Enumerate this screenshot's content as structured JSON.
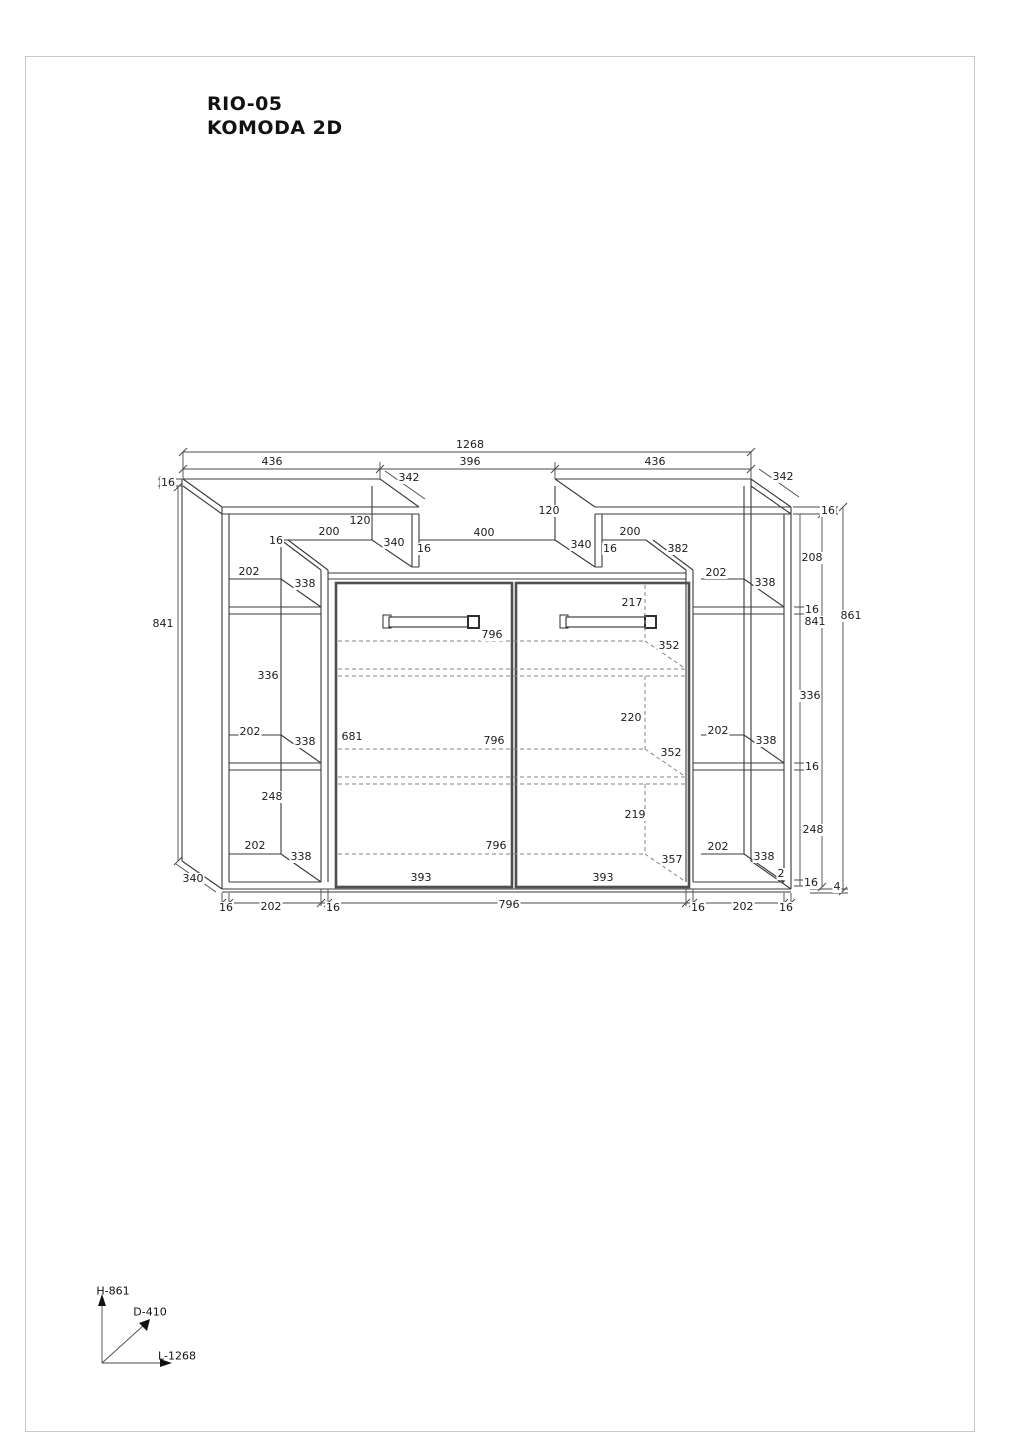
{
  "title": {
    "line1": "RIO-05",
    "line2": "KOMODA 2D"
  },
  "legend": {
    "height_axis": "H-861",
    "depth_axis": "D-410",
    "length_axis": "L-1268"
  },
  "colors": {
    "line": "#3a3a3a",
    "dim": "#4a4a4a",
    "dashed": "#858585",
    "door": "#4f4f4f",
    "text": "#1c1c1c",
    "border": "#c9c9c9"
  },
  "overall_dimensions": {
    "length": "1268",
    "height": "861",
    "depth": "410"
  },
  "diagram": {
    "labels": [
      {
        "t": "1268",
        "x": 470,
        "y": 445
      },
      {
        "t": "436",
        "x": 272,
        "y": 462
      },
      {
        "t": "396",
        "x": 470,
        "y": 462
      },
      {
        "t": "436",
        "x": 655,
        "y": 462
      },
      {
        "t": "342",
        "x": 409,
        "y": 478
      },
      {
        "t": "342",
        "x": 783,
        "y": 477
      },
      {
        "t": "16",
        "x": 168,
        "y": 483
      },
      {
        "t": "120",
        "x": 360,
        "y": 521
      },
      {
        "t": "16",
        "x": 276,
        "y": 541
      },
      {
        "t": "200",
        "x": 329,
        "y": 532
      },
      {
        "t": "340",
        "x": 394,
        "y": 543
      },
      {
        "t": "16",
        "x": 424,
        "y": 549
      },
      {
        "t": "400",
        "x": 484,
        "y": 533
      },
      {
        "t": "120",
        "x": 549,
        "y": 511
      },
      {
        "t": "340",
        "x": 581,
        "y": 545
      },
      {
        "t": "16",
        "x": 610,
        "y": 549
      },
      {
        "t": "200",
        "x": 630,
        "y": 532
      },
      {
        "t": "382",
        "x": 678,
        "y": 549
      },
      {
        "t": "16",
        "x": 828,
        "y": 511
      },
      {
        "t": "202",
        "x": 249,
        "y": 572
      },
      {
        "t": "338",
        "x": 305,
        "y": 584
      },
      {
        "t": "336",
        "x": 268,
        "y": 676
      },
      {
        "t": "202",
        "x": 250,
        "y": 732
      },
      {
        "t": "338",
        "x": 305,
        "y": 742
      },
      {
        "t": "248",
        "x": 272,
        "y": 797
      },
      {
        "t": "202",
        "x": 255,
        "y": 846
      },
      {
        "t": "338",
        "x": 301,
        "y": 857
      },
      {
        "t": "841",
        "x": 163,
        "y": 624
      },
      {
        "t": "340",
        "x": 193,
        "y": 879
      },
      {
        "t": "16",
        "x": 226,
        "y": 908
      },
      {
        "t": "202",
        "x": 271,
        "y": 907
      },
      {
        "t": "16",
        "x": 333,
        "y": 908
      },
      {
        "t": "217",
        "x": 632,
        "y": 603
      },
      {
        "t": "796",
        "x": 492,
        "y": 635
      },
      {
        "t": "352",
        "x": 669,
        "y": 646
      },
      {
        "t": "220",
        "x": 631,
        "y": 718
      },
      {
        "t": "681",
        "x": 352,
        "y": 737
      },
      {
        "t": "796",
        "x": 494,
        "y": 741
      },
      {
        "t": "352",
        "x": 671,
        "y": 753
      },
      {
        "t": "219",
        "x": 635,
        "y": 815
      },
      {
        "t": "796",
        "x": 496,
        "y": 846
      },
      {
        "t": "357",
        "x": 672,
        "y": 860
      },
      {
        "t": "393",
        "x": 421,
        "y": 878
      },
      {
        "t": "393",
        "x": 603,
        "y": 878
      },
      {
        "t": "2",
        "x": 781,
        "y": 874
      },
      {
        "t": "796",
        "x": 509,
        "y": 905
      },
      {
        "t": "16",
        "x": 698,
        "y": 908
      },
      {
        "t": "202",
        "x": 743,
        "y": 907
      },
      {
        "t": "16",
        "x": 786,
        "y": 908
      },
      {
        "t": "202",
        "x": 716,
        "y": 573
      },
      {
        "t": "338",
        "x": 765,
        "y": 583
      },
      {
        "t": "202",
        "x": 718,
        "y": 731
      },
      {
        "t": "338",
        "x": 766,
        "y": 741
      },
      {
        "t": "202",
        "x": 718,
        "y": 847
      },
      {
        "t": "338",
        "x": 764,
        "y": 857
      },
      {
        "t": "208",
        "x": 812,
        "y": 558
      },
      {
        "t": "16",
        "x": 812,
        "y": 610
      },
      {
        "t": "336",
        "x": 810,
        "y": 696
      },
      {
        "t": "16",
        "x": 812,
        "y": 767
      },
      {
        "t": "248",
        "x": 813,
        "y": 830
      },
      {
        "t": "16",
        "x": 811,
        "y": 883
      },
      {
        "t": "4",
        "x": 837,
        "y": 887
      },
      {
        "t": "841",
        "x": 815,
        "y": 622
      },
      {
        "t": "861",
        "x": 851,
        "y": 616
      }
    ],
    "legend_labels": [
      {
        "t": "H-861",
        "x": 113,
        "y": 1291
      },
      {
        "t": "D-410",
        "x": 150,
        "y": 1312
      },
      {
        "t": "L-1268",
        "x": 177,
        "y": 1356
      }
    ]
  }
}
